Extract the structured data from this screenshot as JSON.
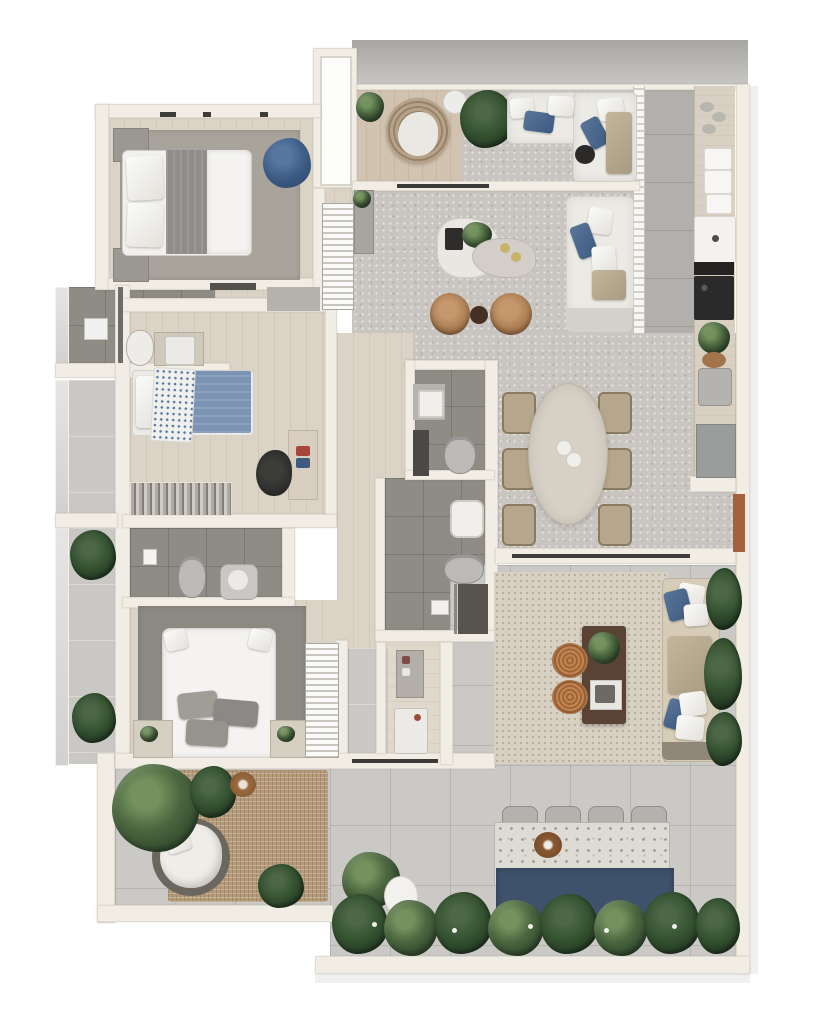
{
  "meta": {
    "type": "3d-floor-plan-render",
    "view": "top-down",
    "text_visible": false
  },
  "colors": {
    "bg": "#ffffff",
    "wall": "#f1ede4",
    "parapet_dark": "#a8a6a3",
    "parapet_light": "#c9c7c4",
    "wood": "#dbd3c6",
    "tile": "#cac8c4",
    "tile_dark": "#b2b0ac",
    "tile_outdoor": "#cbc9c6",
    "bath_floor": "#8f8c86",
    "rug_gray": "#a8a39b",
    "rug_charcoal": "#8c8982",
    "jute": "#b49a79",
    "berber": "#d7d0c3",
    "sofa_white": "#eceae5",
    "pillow_blue": "#3c5a82",
    "bed_blanket": "#8e8d8b",
    "duvet_white": "#f4f3f1",
    "denim": "#7b94b4",
    "navy_chair": "#3c5a82",
    "bar_navy": "#3e526b",
    "caramel": "#a97b50",
    "pouf": "#a26434",
    "table_wood": "#5a4334",
    "terracotta": "#a5613b",
    "green": "#4a663f",
    "green_dark": "#1f3520",
    "counter": "#d8d0c2",
    "terrazzo": "#dedbd4",
    "appliance_gray": "#9b9d9c",
    "cooktop": "#1c1c1c",
    "fixture_white": "#f0efec",
    "fixture_gray": "#bbbab7"
  },
  "scene": {
    "rooms": [
      {
        "id": "master-bedroom",
        "furniture": [
          "double-bed",
          "gray-rug",
          "nightstand-left-top",
          "nightstand-left-bottom",
          "blue-armchair"
        ]
      },
      {
        "id": "master-bathroom",
        "furniture": [
          "shower",
          "toilet",
          "vanity-sink"
        ]
      },
      {
        "id": "entry-foyer",
        "furniture": [
          "entry-door",
          "shoe-shelf",
          "gray-doormat"
        ]
      },
      {
        "id": "balcony-lounge",
        "furniture": [
          "corner-plant",
          "wicker-round-chair",
          "white-side-table",
          "palm-plant",
          "l-shaped-sofa",
          "black-side-table"
        ]
      },
      {
        "id": "living-room",
        "furniture": [
          "sideboard",
          "sideboard-plant",
          "organic-coffee-table-white",
          "organic-coffee-table-beige",
          "table-plant",
          "caramel-armchair-1",
          "caramel-armchair-2",
          "dark-side-table",
          "white-sofa"
        ]
      },
      {
        "id": "kitchen",
        "furniture": [
          "partition-screen",
          "counter-run",
          "dishes",
          "towels",
          "white-sink-unit",
          "cooktop-4-burner",
          "counter-plant",
          "basket",
          "gray-sink",
          "base-cabinet",
          "terracotta-planter"
        ]
      },
      {
        "id": "dining-room",
        "furniture": [
          "oval-table",
          "chair-1",
          "chair-2",
          "chair-3",
          "chair-4",
          "chair-5",
          "chair-6",
          "centerpiece"
        ]
      },
      {
        "id": "bedroom-2",
        "furniture": [
          "single-bed-blue",
          "patterned-throw",
          "desk",
          "desk-chair",
          "clothes-rack"
        ]
      },
      {
        "id": "bathroom-2",
        "furniture": [
          "wall-sink",
          "dark-counter",
          "toilet"
        ]
      },
      {
        "id": "bathroom-3",
        "furniture": [
          "round-sink",
          "toilet",
          "shower",
          "shower-control"
        ]
      },
      {
        "id": "bathroom-4",
        "furniture": [
          "light-switch",
          "toilet",
          "sink"
        ]
      },
      {
        "id": "bedroom-3",
        "furniture": [
          "double-bed-white",
          "charcoal-rug",
          "nightstand-plant-left",
          "nightstand-plant-right",
          "open-wardrobe"
        ]
      },
      {
        "id": "laundry-nook",
        "furniture": [
          "console-with-items",
          "washing-machine"
        ]
      },
      {
        "id": "side-balcony-upper",
        "furniture": []
      },
      {
        "id": "side-balcony-lower",
        "furniture": [
          "plant-upper",
          "plant-lower"
        ]
      },
      {
        "id": "terrace-left",
        "furniture": [
          "jute-rug",
          "round-daybed",
          "corner-bush",
          "palm-bush",
          "wicker-side-table",
          "dark-bush"
        ]
      },
      {
        "id": "terrace-lounge",
        "furniture": [
          "berber-rug",
          "wood-coffee-table",
          "table-plant",
          "serving-tray",
          "pouf-1",
          "pouf-2",
          "outdoor-sofa",
          "climbing-plants"
        ]
      },
      {
        "id": "terrace-bar",
        "furniture": [
          "bar-counter",
          "bar-stool-1",
          "bar-stool-2",
          "bar-stool-3",
          "bar-stool-4",
          "wood-bowl",
          "navy-bar-base",
          "hedge-planting",
          "egg-planter",
          "bushes"
        ]
      }
    ]
  }
}
